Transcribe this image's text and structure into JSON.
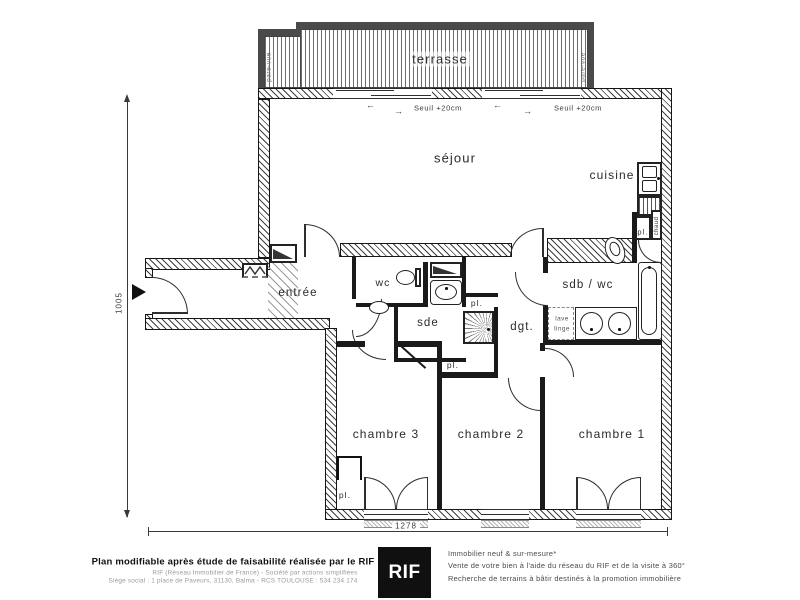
{
  "plan": {
    "rooms": {
      "terrasse": "terrasse",
      "sejour": "séjour",
      "cuisine": "cuisine",
      "entree": "entrée",
      "wc": "wc",
      "sde": "sde",
      "dgt": "dgt.",
      "sdb_wc": "sdb / wc",
      "chambre1": "chambre 1",
      "chambre2": "chambre 2",
      "chambre3": "chambre 3"
    },
    "small_labels": {
      "pl": "pl.",
      "chaud": "chaud",
      "lave_line1": "lave",
      "lave_line2": "linge",
      "pare_vue": "pare-vue",
      "seuil": "Seuil +20cm"
    },
    "dims": {
      "height": "1005",
      "width": "1278"
    },
    "icons": {
      "arrow_left": "←",
      "arrow_right": "→"
    }
  },
  "footer": {
    "left_bold": "Plan modifiable après étude de faisabilité réalisée par le RIF",
    "left_line2": "RIF (Réseau Immobilier de France) - Société par actions simplifiées",
    "left_line3": "Siège social : 1 place de Paveurs, 31130, Balma - RCS TOULOUSE : 534 234 174",
    "logo": "RIF",
    "right_line1": "Immobilier neuf & sur-mesure*",
    "right_line2": "Vente de votre bien à l'aide du réseau du RIF et de la visite à 360°",
    "right_line3": "Recherche de terrains à bâtir destinés à la promotion immobilière"
  }
}
